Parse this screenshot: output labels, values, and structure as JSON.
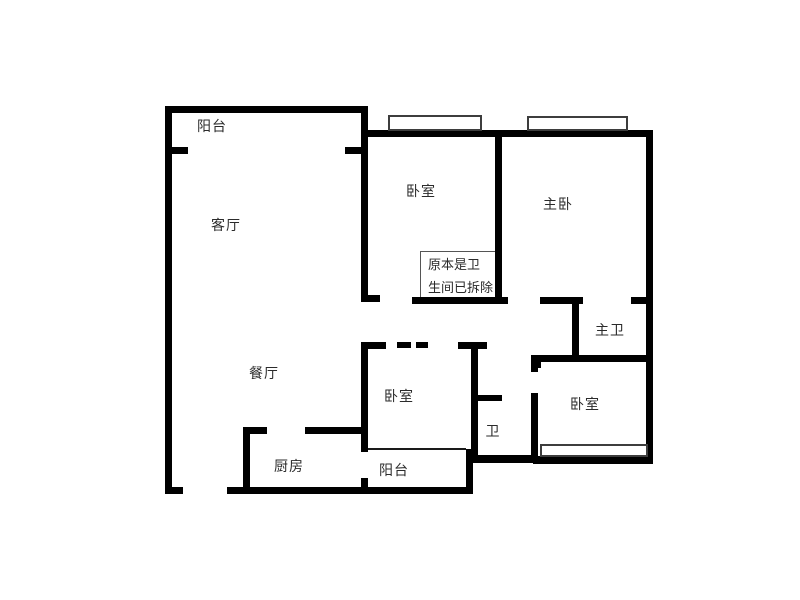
{
  "canvas": {
    "width": 800,
    "height": 600,
    "background": "#ffffff"
  },
  "colors": {
    "wall": "#000000",
    "thin_line": "#1a1a1a",
    "window_outline": "#3d3d3d",
    "label_text": "#2b2b2b",
    "note_border": "#555555"
  },
  "labels": [
    {
      "name": "label-balcony-top",
      "text": "阳台",
      "cx": 212,
      "cy": 127
    },
    {
      "name": "label-living-room",
      "text": "客厅",
      "cx": 226,
      "cy": 226
    },
    {
      "name": "label-bedroom-top",
      "text": "卧室",
      "cx": 421,
      "cy": 192
    },
    {
      "name": "label-master-bedroom",
      "text": "主卧",
      "cx": 558,
      "cy": 205
    },
    {
      "name": "label-master-bath",
      "text": "主卫",
      "cx": 610,
      "cy": 331
    },
    {
      "name": "label-dining-room",
      "text": "餐厅",
      "cx": 264,
      "cy": 374
    },
    {
      "name": "label-bedroom-middle",
      "text": "卧室",
      "cx": 399,
      "cy": 397
    },
    {
      "name": "label-bath",
      "text": "卫",
      "cx": 493,
      "cy": 432
    },
    {
      "name": "label-bedroom-right",
      "text": "卧室",
      "cx": 585,
      "cy": 405
    },
    {
      "name": "label-kitchen",
      "text": "厨房",
      "cx": 289,
      "cy": 467
    },
    {
      "name": "label-balcony-bottom",
      "text": "阳台",
      "cx": 394,
      "cy": 471
    }
  ],
  "note_box": {
    "name": "note-demolished-bathroom",
    "x": 420,
    "y": 251,
    "w": 79,
    "h": 49,
    "lines": [
      "原本是卫",
      "生间已拆除"
    ]
  },
  "walls": [
    {
      "name": "wall-top-left-outer",
      "x": 165,
      "y": 106,
      "w": 203,
      "h": 7
    },
    {
      "name": "wall-left-outer",
      "x": 165,
      "y": 106,
      "w": 7,
      "h": 388
    },
    {
      "name": "wall-bottom-left-foot",
      "x": 165,
      "y": 487,
      "w": 18,
      "h": 7
    },
    {
      "name": "wall-bottom-outer",
      "x": 227,
      "y": 487,
      "w": 246,
      "h": 7
    },
    {
      "name": "wall-balcony-divider-left",
      "x": 165,
      "y": 147,
      "w": 23,
      "h": 7
    },
    {
      "name": "wall-balcony-divider-right",
      "x": 345,
      "y": 147,
      "w": 23,
      "h": 7
    },
    {
      "name": "wall-living-right",
      "x": 361,
      "y": 113,
      "w": 7,
      "h": 189
    },
    {
      "name": "wall-living-right-foot",
      "x": 361,
      "y": 295,
      "w": 19,
      "h": 7
    },
    {
      "name": "wall-bedrooms-top",
      "x": 361,
      "y": 130,
      "w": 292,
      "h": 7
    },
    {
      "name": "wall-right-outer",
      "x": 646,
      "y": 130,
      "w": 7,
      "h": 334
    },
    {
      "name": "wall-bedroom-divider",
      "x": 495,
      "y": 137,
      "w": 7,
      "h": 163
    },
    {
      "name": "wall-hall-top-a",
      "x": 412,
      "y": 297,
      "w": 96,
      "h": 7
    },
    {
      "name": "wall-hall-top-b",
      "x": 540,
      "y": 297,
      "w": 43,
      "h": 7
    },
    {
      "name": "wall-masterbath-door-tick",
      "x": 631,
      "y": 297,
      "w": 17,
      "h": 7
    },
    {
      "name": "wall-masterbath-left",
      "x": 572,
      "y": 301,
      "w": 7,
      "h": 57
    },
    {
      "name": "wall-bedroom-right-top",
      "x": 533,
      "y": 355,
      "w": 113,
      "h": 7
    },
    {
      "name": "wall-bedroom-right-top-stub",
      "x": 533,
      "y": 355,
      "w": 8,
      "h": 13
    },
    {
      "name": "wall-bedroom-right-left-a",
      "x": 531,
      "y": 355,
      "w": 7,
      "h": 17
    },
    {
      "name": "wall-bedroom-right-left-b",
      "x": 531,
      "y": 393,
      "w": 7,
      "h": 64
    },
    {
      "name": "wall-bath-left",
      "x": 471,
      "y": 348,
      "w": 7,
      "h": 109
    },
    {
      "name": "wall-bath-t-head",
      "x": 458,
      "y": 342,
      "w": 29,
      "h": 7
    },
    {
      "name": "wall-bath-door-tick",
      "x": 471,
      "y": 395,
      "w": 31,
      "h": 6
    },
    {
      "name": "wall-dashed-corner",
      "x": 361,
      "y": 342,
      "w": 25,
      "h": 7
    },
    {
      "name": "wall-dash-1",
      "x": 397,
      "y": 342,
      "w": 14,
      "h": 6
    },
    {
      "name": "wall-dash-2",
      "x": 416,
      "y": 342,
      "w": 12,
      "h": 6
    },
    {
      "name": "wall-bedroom-middle-left",
      "x": 361,
      "y": 342,
      "w": 7,
      "h": 110
    },
    {
      "name": "wall-balcony2-left-foot",
      "x": 361,
      "y": 478,
      "w": 7,
      "h": 16
    },
    {
      "name": "wall-kitchen-left",
      "x": 243,
      "y": 428,
      "w": 7,
      "h": 66
    },
    {
      "name": "wall-kitchen-top-a",
      "x": 243,
      "y": 427,
      "w": 24,
      "h": 7
    },
    {
      "name": "wall-kitchen-top-b",
      "x": 305,
      "y": 427,
      "w": 60,
      "h": 7
    },
    {
      "name": "wall-balcony2-right",
      "x": 466,
      "y": 449,
      "w": 7,
      "h": 45
    },
    {
      "name": "wall-bath-bottom-step",
      "x": 471,
      "y": 455,
      "w": 62,
      "h": 8
    },
    {
      "name": "wall-bedroom-right-bottom",
      "x": 533,
      "y": 456,
      "w": 120,
      "h": 8
    }
  ],
  "thin_lines": [
    {
      "name": "line-bedroom-balcony-divider",
      "x": 368,
      "y": 448,
      "w": 98,
      "h": 2
    }
  ],
  "windows": [
    {
      "name": "window-bedroom-top",
      "x": 388,
      "y": 115,
      "w": 94,
      "h": 16
    },
    {
      "name": "window-master-bedroom",
      "x": 527,
      "y": 116,
      "w": 101,
      "h": 15
    },
    {
      "name": "window-bedroom-right",
      "x": 540,
      "y": 444,
      "w": 108,
      "h": 13
    }
  ]
}
